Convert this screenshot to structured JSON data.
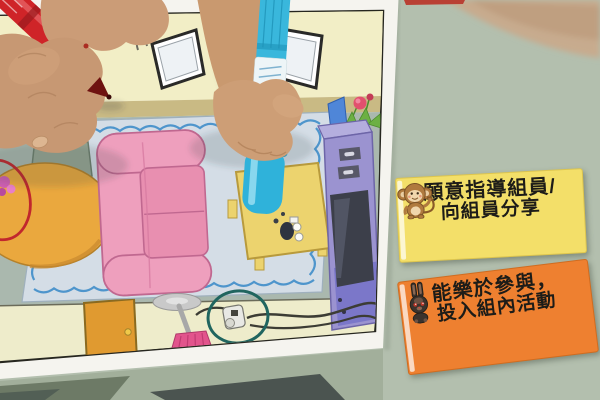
{
  "scene": {
    "type": "photograph",
    "description": "Children's hands drawing with markers on a printed living-room worksheet; two reward cards lie on the green table",
    "table_color": "#b3bfae"
  },
  "worksheet": {
    "page_color": "#f5f4ef",
    "room_objects": [
      "window",
      "motion-lines",
      "rug",
      "sofa",
      "coffee-table",
      "teacups",
      "tv-cabinet",
      "tv",
      "plant",
      "magazine-file",
      "round-table",
      "chair",
      "flowers",
      "floor-lamp",
      "power-outlet",
      "cords",
      "beach-picture",
      "door"
    ],
    "room_colors": {
      "wall": "#f2eec6",
      "floor": "#aab8ae",
      "rug": "#d4dde6",
      "rug_border": "#4e95cc",
      "sofa": "#ee9fbd",
      "coffee_table": "#ecd36e",
      "cabinet": "#9b93d0",
      "door": "#e09a30",
      "round_table": "#eaa83e",
      "lamp_shade": "#e2548c"
    },
    "annotations": [
      {
        "shape": "ellipse",
        "color": "#c1272d",
        "around": "flowers-on-round-table"
      },
      {
        "shape": "ellipse",
        "color": "#20655f",
        "around": "power-outlet-and-cords"
      }
    ]
  },
  "markers": [
    {
      "id": "red-marker",
      "color": "#cf2428"
    },
    {
      "id": "blue-marker",
      "color": "#35b3d8"
    }
  ],
  "cards": [
    {
      "bg": "#f3df69",
      "lines": [
        "願意指導組員/",
        "向組員分享"
      ],
      "mascot": "monkey"
    },
    {
      "bg": "#ee8030",
      "lines": [
        "能樂於參與，",
        "投入組內活動"
      ],
      "mascot": "rabbit"
    }
  ]
}
